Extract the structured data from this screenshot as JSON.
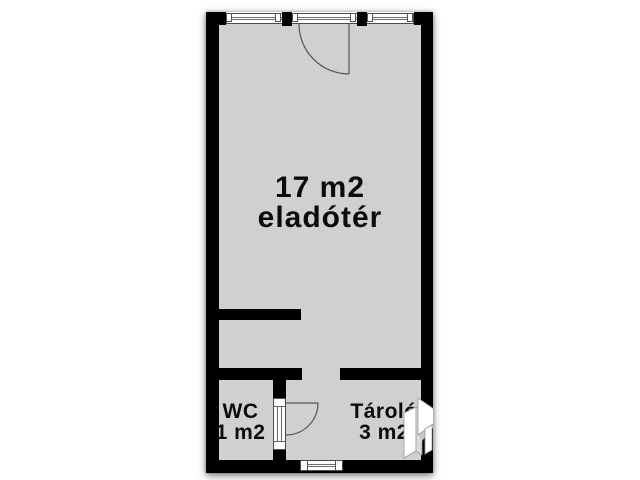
{
  "plan": {
    "type": "floor-plan",
    "colors": {
      "background": "#ffffff",
      "floor": "#d0d0cf",
      "wall": "#000000",
      "text": "#0c0c0c"
    },
    "rooms": {
      "sales": {
        "area": "17 m2",
        "name": "eladótér"
      },
      "wc": {
        "name": "WC",
        "area": "1 m2"
      },
      "storage": {
        "name": "Tároló",
        "area": "3 m2"
      }
    },
    "icons": [
      "door-swing-icon",
      "wc-door-swing-icon",
      "entrance-arrow-icon",
      "window-icon"
    ]
  }
}
